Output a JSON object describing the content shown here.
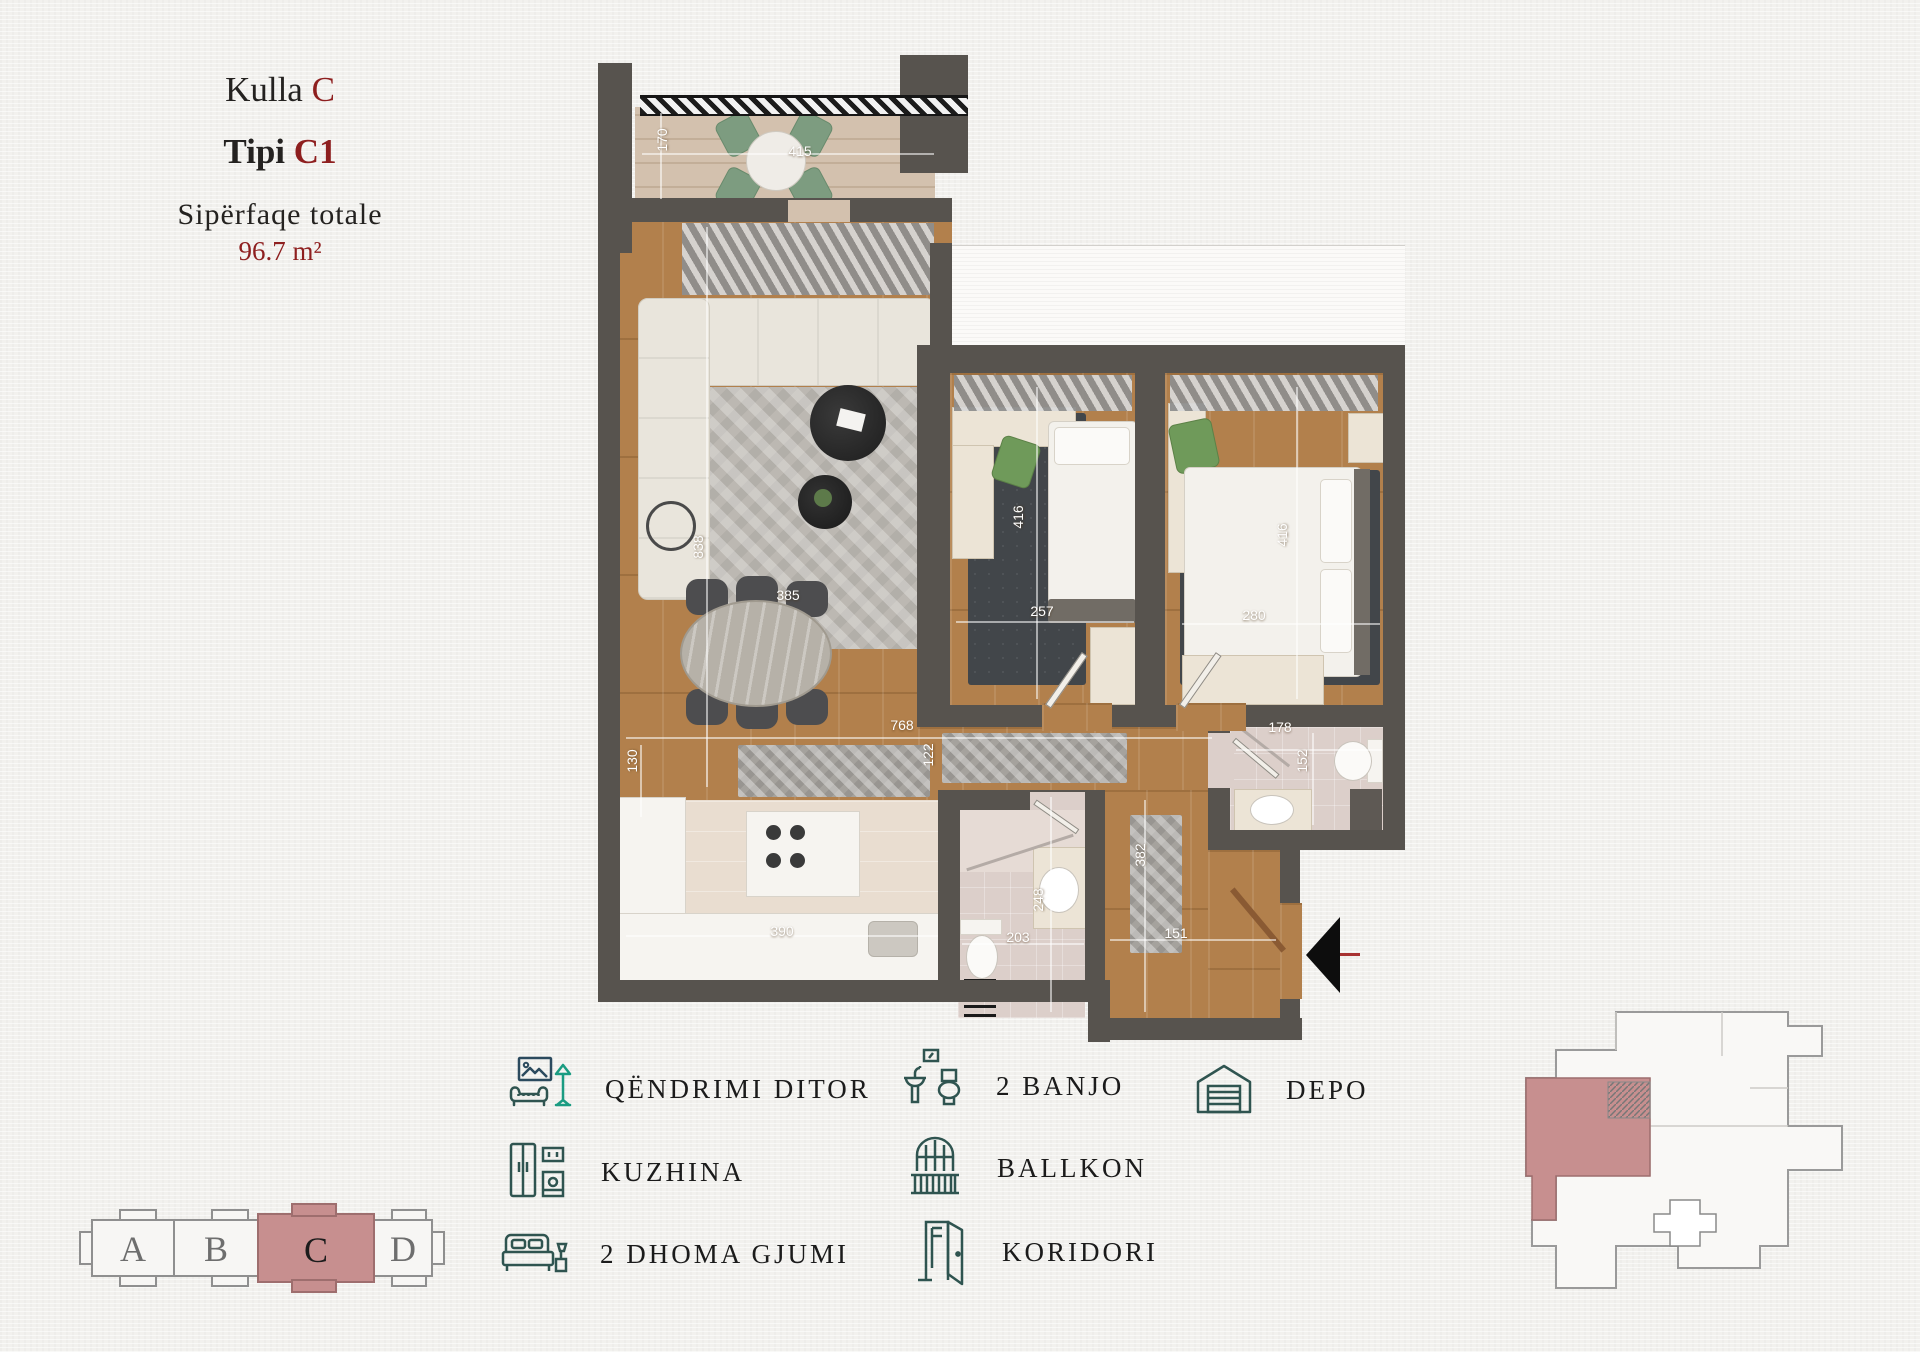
{
  "title": {
    "line1_black": "Kulla",
    "line1_red": "C",
    "line2_black": "Tipi",
    "line2_red": "C1",
    "line3": "Sipërfaqe totale",
    "line4": "96.7 m²"
  },
  "plan": {
    "dims": {
      "balcony_depth": "170",
      "balcony_width": "415",
      "living_height": "838",
      "dining_width": "385",
      "hall_width": "768",
      "hall_gap": "122",
      "bedroom1_height": "416",
      "bedroom1_width": "257",
      "bedroom2_height": "416",
      "bedroom2_width": "280",
      "bath1_width": "178",
      "bath1_height": "152",
      "bath2_height": "248",
      "bath2_width": "203",
      "entry_height": "382",
      "entry_width": "151",
      "kitchen_width": "390",
      "kitchen_depth": "130"
    }
  },
  "legend": {
    "items": [
      {
        "id": "living",
        "label": "QËNDRIMI DITOR"
      },
      {
        "id": "kitchen",
        "label": "KUZHINA"
      },
      {
        "id": "bedrooms",
        "label": "2 DHOMA GJUMI"
      },
      {
        "id": "bathrooms",
        "label": "2 BANJO"
      },
      {
        "id": "balcony",
        "label": "BALLKON"
      },
      {
        "id": "corridor",
        "label": "KORIDORI"
      },
      {
        "id": "storage",
        "label": "DEPO"
      }
    ]
  },
  "selector": {
    "sections": [
      "A",
      "B",
      "C",
      "D"
    ],
    "active": "C"
  },
  "colors": {
    "accent_red": "#8e1f1f",
    "highlight_pink": "#c78f8f",
    "legend_icon": "#2f5450",
    "wall": "#57534e"
  }
}
